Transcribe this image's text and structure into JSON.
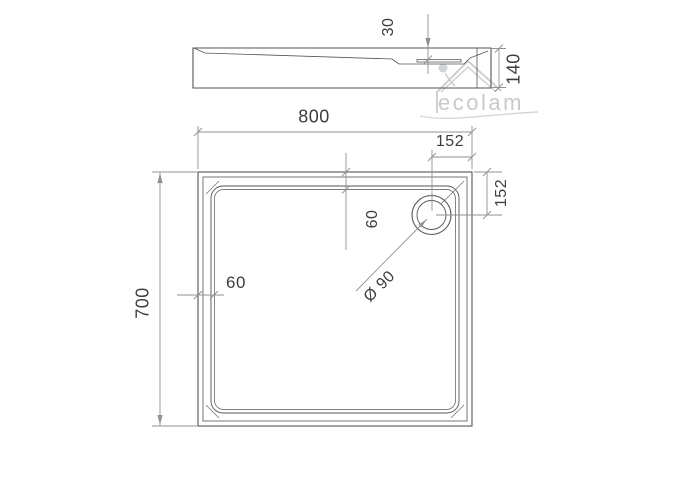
{
  "watermark": {
    "brand": "ecolam"
  },
  "side_view": {
    "inner_depth": "30",
    "total_height": "140"
  },
  "plan_view": {
    "width": "800",
    "length": "700",
    "drain_offset_from_top": "152",
    "drain_offset_from_side": "152",
    "rim_width_top": "60",
    "rim_width_left": "60",
    "drain_diameter": "Ø 90"
  }
}
